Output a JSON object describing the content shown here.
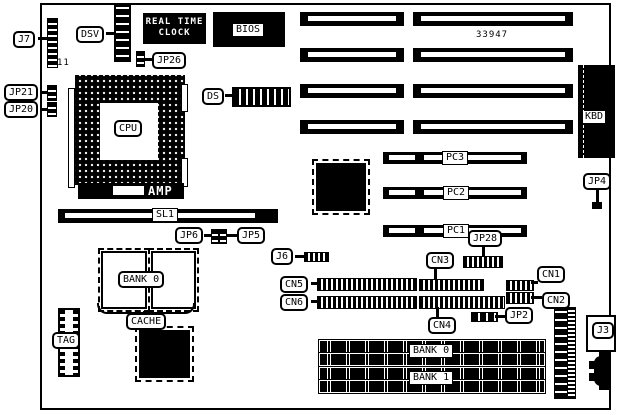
{
  "figure": {
    "part_number": "33947",
    "j7_pin_label": "11"
  },
  "chips": {
    "rtc_line1": "REAL TIME",
    "rtc_line2": "CLOCK",
    "bios": "BIOS",
    "cpu": "CPU",
    "amp": "AMP",
    "kbd": "KBD"
  },
  "connectors": {
    "j7": "J7",
    "dsv": "DSV",
    "ds": "DS",
    "jp26": "JP26",
    "jp21": "JP21",
    "jp20": "JP20",
    "sl1": "SL1",
    "jp6": "JP6",
    "jp5": "JP5",
    "j6": "J6",
    "jp4": "JP4",
    "pc3": "PC3",
    "pc2": "PC2",
    "pc1": "PC1",
    "jp28": "JP28",
    "cn1": "CN1",
    "cn2": "CN2",
    "cn3": "CN3",
    "cn4": "CN4",
    "cn5": "CN5",
    "cn6": "CN6",
    "jp2": "JP2",
    "j3": "J3"
  },
  "memory": {
    "cache_bank0": "BANK 0",
    "cache": "CACHE",
    "tag": "TAG",
    "simm_bank0": "BANK 0",
    "simm_bank1": "BANK 1"
  }
}
